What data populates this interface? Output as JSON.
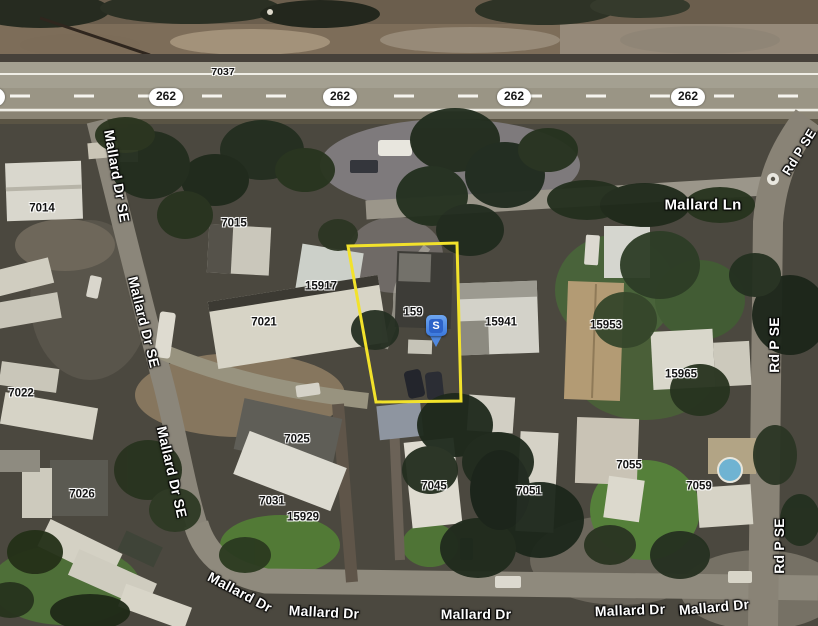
{
  "map": {
    "view_type": "satellite",
    "route_number": "262",
    "shield_positions": [
      {
        "x": 166,
        "y": 97
      },
      {
        "x": 340,
        "y": 97
      },
      {
        "x": 514,
        "y": 97
      },
      {
        "x": 688,
        "y": 97
      },
      {
        "x": -12,
        "y": 97
      }
    ],
    "street_labels": [
      {
        "text": "Mallard Dr SE",
        "x": 117,
        "y": 176,
        "rot": 80,
        "size": 14
      },
      {
        "text": "Mallard Dr SE",
        "x": 144,
        "y": 322,
        "rot": 76,
        "size": 14
      },
      {
        "text": "Mallard Dr SE",
        "x": 172,
        "y": 472,
        "rot": 77,
        "size": 14
      },
      {
        "text": "Mallard Ln",
        "x": 703,
        "y": 205,
        "rot": 0,
        "size": 15
      },
      {
        "text": "Rd P SE",
        "x": 799,
        "y": 152,
        "rot": -58,
        "size": 13
      },
      {
        "text": "Rd P SE",
        "x": 774,
        "y": 345,
        "rot": -90,
        "size": 14
      },
      {
        "text": "Rd P SE",
        "x": 779,
        "y": 546,
        "rot": -90,
        "size": 14
      },
      {
        "text": "Mallard Dr",
        "x": 240,
        "y": 592,
        "rot": 28,
        "size": 14
      },
      {
        "text": "Mallard Dr",
        "x": 324,
        "y": 612,
        "rot": 3,
        "size": 14
      },
      {
        "text": "Mallard Dr",
        "x": 476,
        "y": 614,
        "rot": 0,
        "size": 14
      },
      {
        "text": "Mallard Dr",
        "x": 630,
        "y": 610,
        "rot": -2,
        "size": 14
      },
      {
        "text": "Mallard Dr",
        "x": 714,
        "y": 607,
        "rot": -5,
        "size": 14
      }
    ],
    "address_labels": [
      {
        "text": "7037",
        "x": 223,
        "y": 72,
        "size": 10.5
      },
      {
        "text": "7014",
        "x": 42,
        "y": 209
      },
      {
        "text": "7015",
        "x": 234,
        "y": 224
      },
      {
        "text": "15917",
        "x": 321,
        "y": 287
      },
      {
        "text": "7021",
        "x": 264,
        "y": 323
      },
      {
        "text": "159",
        "x": 413,
        "y": 313
      },
      {
        "text": "15941",
        "x": 501,
        "y": 323
      },
      {
        "text": "15953",
        "x": 606,
        "y": 326
      },
      {
        "text": "15965",
        "x": 681,
        "y": 375
      },
      {
        "text": "7022",
        "x": 21,
        "y": 394
      },
      {
        "text": "7026",
        "x": 82,
        "y": 495
      },
      {
        "text": "7025",
        "x": 297,
        "y": 440
      },
      {
        "text": "7031",
        "x": 272,
        "y": 502
      },
      {
        "text": "15929",
        "x": 303,
        "y": 518
      },
      {
        "text": "7045",
        "x": 434,
        "y": 487
      },
      {
        "text": "7051",
        "x": 529,
        "y": 492
      },
      {
        "text": "7055",
        "x": 629,
        "y": 466
      },
      {
        "text": "7059",
        "x": 699,
        "y": 487
      }
    ],
    "marker": {
      "letter": "S",
      "x": 436,
      "y": 347,
      "head_top": "#6ea6f0",
      "head_bottom": "#3b79dd",
      "inner": "#2d63c9",
      "tail": "#4f88df"
    },
    "parcel_outline": {
      "color": "#f2e22b",
      "points": "348,246 457,243 461,401 376,402"
    }
  }
}
